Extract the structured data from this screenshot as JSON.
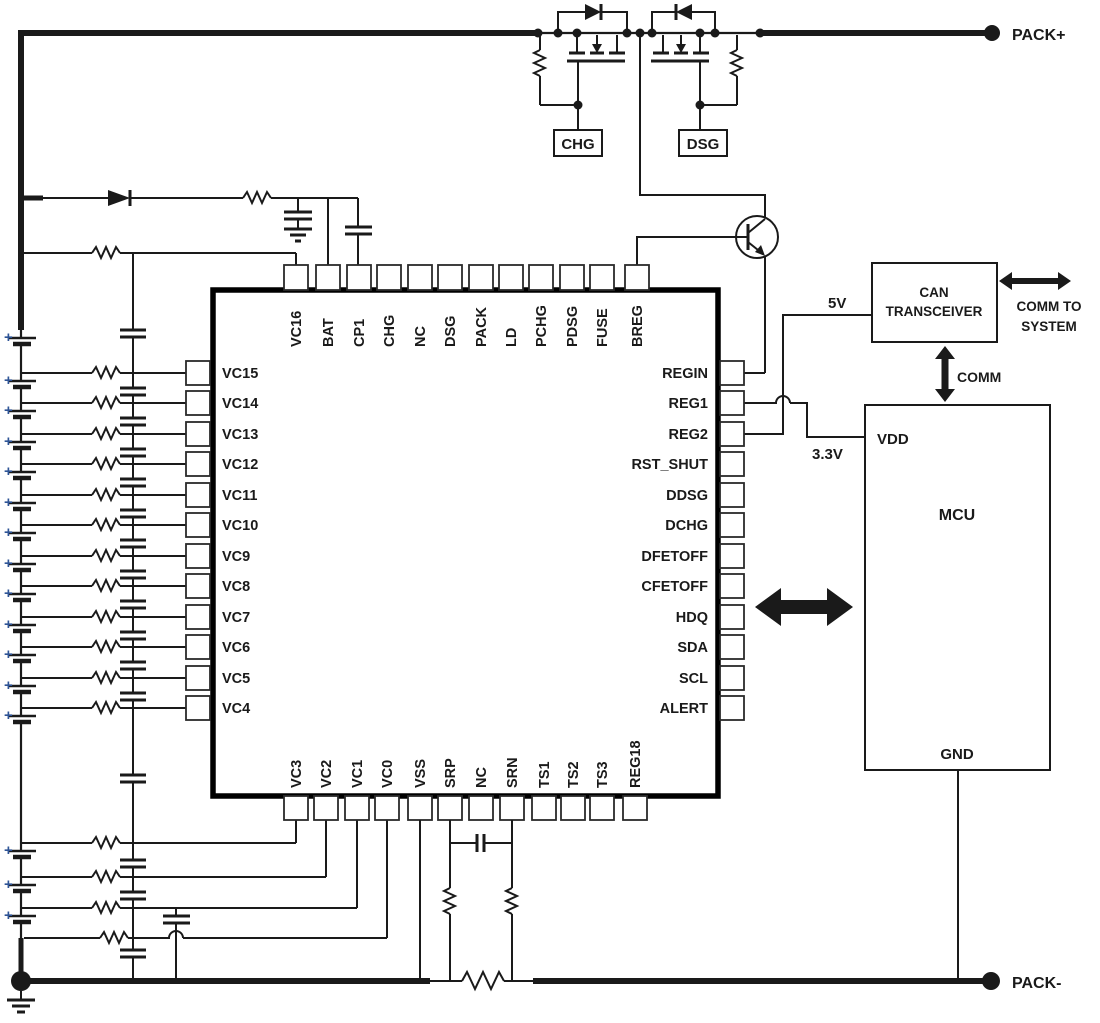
{
  "terminals": {
    "pack_plus": "PACK+",
    "pack_minus": "PACK-"
  },
  "fets": {
    "chg_label": "CHG",
    "dsg_label": "DSG"
  },
  "power": {
    "v5": "5V",
    "v33": "3.3V"
  },
  "can": {
    "line1": "CAN",
    "line2": "TRANSCEIVER",
    "comm": "COMM",
    "comm_to_line1": "COMM TO",
    "comm_to_line2": "SYSTEM"
  },
  "mcu": {
    "vdd": "VDD",
    "name": "MCU",
    "gnd": "GND"
  },
  "battery": {
    "plus": "+",
    "cell_count": 16
  },
  "ic": {
    "pins": {
      "top": [
        "VC16",
        "BAT",
        "CP1",
        "CHG",
        "NC",
        "DSG",
        "PACK",
        "LD",
        "PCHG",
        "PDSG",
        "FUSE",
        "BREG"
      ],
      "left": [
        "VC15",
        "VC14",
        "VC13",
        "VC12",
        "VC11",
        "VC10",
        "VC9",
        "VC8",
        "VC7",
        "VC6",
        "VC5",
        "VC4"
      ],
      "right": [
        "REGIN",
        "REG1",
        "REG2",
        "RST_SHUT",
        "DDSG",
        "DCHG",
        "DFETOFF",
        "CFETOFF",
        "HDQ",
        "SDA",
        "SCL",
        "ALERT"
      ],
      "bottom": [
        "VC3",
        "VC2",
        "VC1",
        "VC0",
        "VSS",
        "SRP",
        "NC",
        "SRN",
        "TS1",
        "TS2",
        "TS3",
        "REG18"
      ]
    }
  },
  "colors": {
    "wire": "#1a1a1a",
    "plus_blue": "#2e5496",
    "background": "#ffffff"
  }
}
